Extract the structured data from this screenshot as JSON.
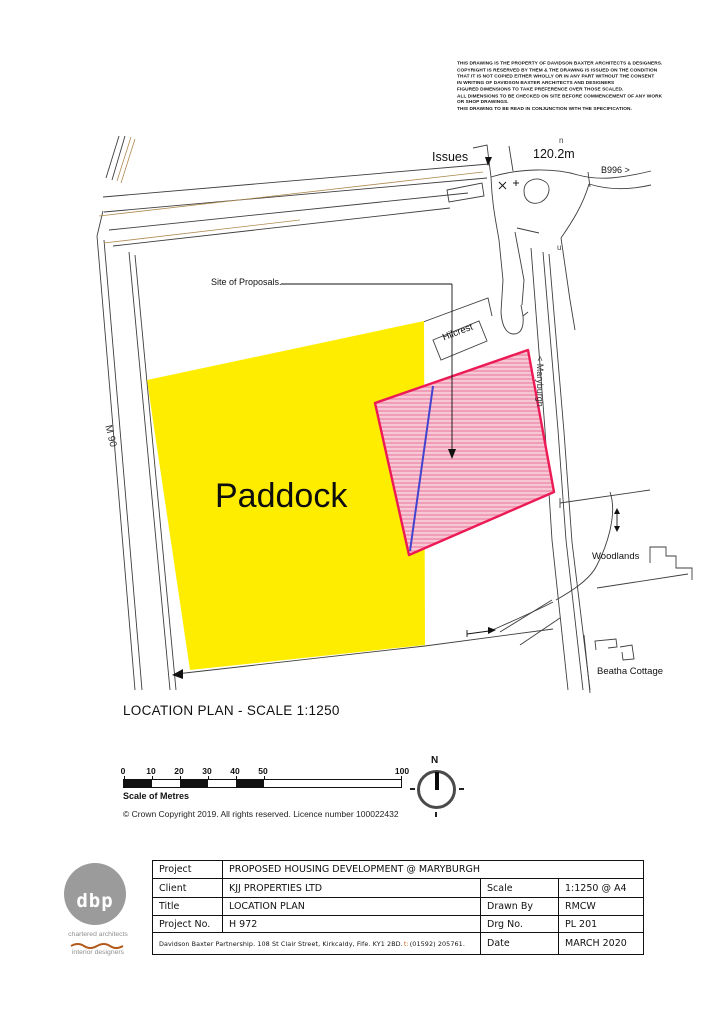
{
  "disclaimer": "THIS DRAWING IS THE PROPERTY OF DAVIDSON BAXTER ARCHITECTS & DESIGNERS.\nCOPYRIGHT IS RESERVED BY THEM & THE DRAWING IS ISSUED ON THE CONDITION\nTHAT IT IS NOT COPIED EITHER WHOLLY OR IN ANY PART WITHOUT THE CONSENT\nIN WRITING OF DAVIDSON BAXTER ARCHITECTS AND DESIGNERS\nFIGURED DIMENSIONS TO TAKE PREFERENCE OVER THOSE SCALED.\nALL DIMENSIONS TO BE CHECKED ON SITE BEFORE COMMENCEMENT OF ANY WORK\nOR SHOP DRAWINGS.\nTHIS DRAWING TO BE READ IN CONJUNCTION WITH THE SPECIFICATION.",
  "map": {
    "labels": {
      "issues": "Issues",
      "spot_height": "120.2m",
      "b996": "B996 >",
      "char_n": "n",
      "char_u": "u",
      "site_of_proposals": "Site of Proposals.",
      "hilcrest": "Hilcrest",
      "maryburgh": "< Maryburgh",
      "m90": "M 90",
      "paddock": "Paddock",
      "woodlands": "Woodlands",
      "beatha_cottage": "Beatha Cottage"
    },
    "colors": {
      "paddock_fill": "#ffed00",
      "site_outline": "#ec1b56",
      "site_fill_light": "#f7c7d4",
      "site_fill_dark": "#ef9db8",
      "proposal_line": "#4343cf",
      "contour_brown": "#b08a4e"
    }
  },
  "caption": "LOCATION PLAN - SCALE 1:1250",
  "scale_bar": {
    "ticks": [
      "0",
      "10",
      "20",
      "30",
      "40",
      "50",
      "100"
    ],
    "label": "Scale of Metres",
    "copyright": "© Crown Copyright 2019. All rights reserved. Licence number 100022432"
  },
  "compass": {
    "north": "N"
  },
  "title_block": {
    "row1": {
      "label": "Project",
      "value": "PROPOSED HOUSING DEVELOPMENT @ MARYBURGH"
    },
    "row2": {
      "label": "Client",
      "value": "KJJ PROPERTIES LTD",
      "label2": "Scale",
      "value2": "1:1250 @ A4"
    },
    "row3": {
      "label": "Title",
      "value": "LOCATION PLAN",
      "label2": "Drawn By",
      "value2": "RMCW"
    },
    "row4": {
      "label": "Project No.",
      "value": "H 972",
      "label2": "Drg No.",
      "value2": "PL 201"
    },
    "row5": {
      "address_main": "Davidson Baxter Partnership. 108 St Clair Street, Kirkcaldy, Fife. KY1 2BD. ",
      "address_t": "t:",
      "address_phone": " (01592) 205761.",
      "label2": "Date",
      "value2": "MARCH 2020"
    }
  },
  "logo": {
    "monogram": "dbp",
    "line1": "chartered architects",
    "line2": "interior designers"
  }
}
